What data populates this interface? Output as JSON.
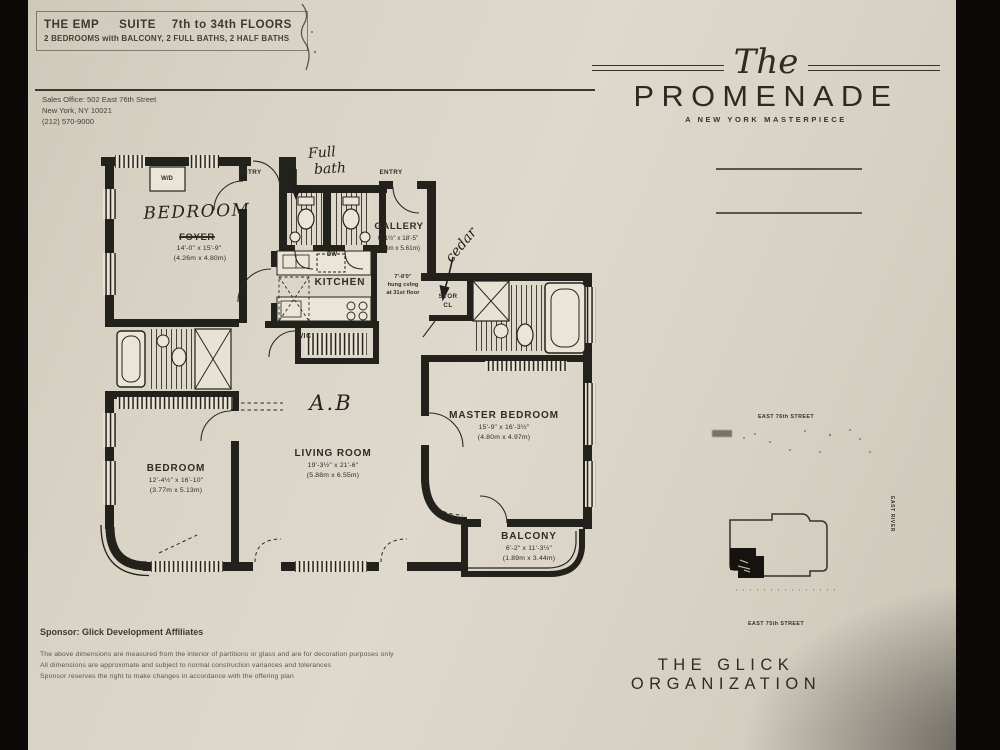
{
  "colors": {
    "paper": "#d8d2c4",
    "ink": "#2e2c25",
    "wall": "#23211b",
    "photo_bg": "#0c0b09"
  },
  "header": {
    "l1a": "THE EMP",
    "l1b": "SUITE",
    "l1c": "7th to 34th FLOORS",
    "l2": "2 BEDROOMS with BALCONY, 2 FULL BATHS, 2 HALF BATHS"
  },
  "sales_office": {
    "l1": "Sales Office: 502 East 76th Street",
    "l2": "New York, NY 10021",
    "l3": "(212) 570-9000"
  },
  "logo": {
    "script": "The",
    "name": "PROMENADE",
    "tagline": "A NEW YORK MASTERPIECE"
  },
  "plan": {
    "labels": {
      "entry_left": "ENTRY",
      "entry_right": "ENTRY",
      "wd": "W/D",
      "dw": "DW"
    },
    "rooms": {
      "foyer": {
        "printed": "FOYER",
        "dims": "14'-0\" x 15'-9\"",
        "metric": "(4.26m x 4.80m)"
      },
      "gallery": {
        "name": "GALLERY",
        "dims": "6'-1½\" x 18'-5\"",
        "metric": "(1.86m x 5.61m)"
      },
      "kitchen": {
        "name": "KITCHEN"
      },
      "wic": {
        "name": "WIC"
      },
      "stor": {
        "l1": "STOR",
        "l2": "CL"
      },
      "living": {
        "name": "LIVING ROOM",
        "dims": "19'-3½\" x 21'-6\"",
        "metric": "(5.88m x 6.55m)"
      },
      "bedroom2": {
        "name": "BEDROOM",
        "dims": "12'-4½\" x 16'-10\"",
        "metric": "(3.77m x 5.13m)"
      },
      "master": {
        "name": "MASTER BEDROOM",
        "dims": "15'-9\" x 16'-3½\"",
        "metric": "(4.80m x 4.97m)"
      },
      "balcony": {
        "name": "BALCONY",
        "dims": "6'-2\" x 11'-3½\"",
        "metric": "(1.89m x 3.44m)"
      }
    },
    "ceiling_note": {
      "l1": "7'-8'0\"",
      "l2": "hung cvlng",
      "l3": "at 31st floor"
    },
    "handwriting": {
      "full1": "Full",
      "full2": "bath",
      "bedroom": "BEDROOM",
      "cedar": "cedar",
      "initials": "A.B"
    }
  },
  "map": {
    "street_top": "EAST 76th STREET",
    "street_bottom": "EAST 75th STREET",
    "river": "EAST RIVER"
  },
  "footer": {
    "sponsor": "Sponsor: Glick Development Affiliates",
    "d1": "The above dimensions are measured from the interior of partitions or glass and are for decoration purposes only",
    "d2": "All dimensions are approximate and subject to normal construction variances and tolerances",
    "d3": "Sponsor reserves the right to make changes in accordance with the offering plan",
    "org": "THE GLICK ORGANIZATION"
  }
}
